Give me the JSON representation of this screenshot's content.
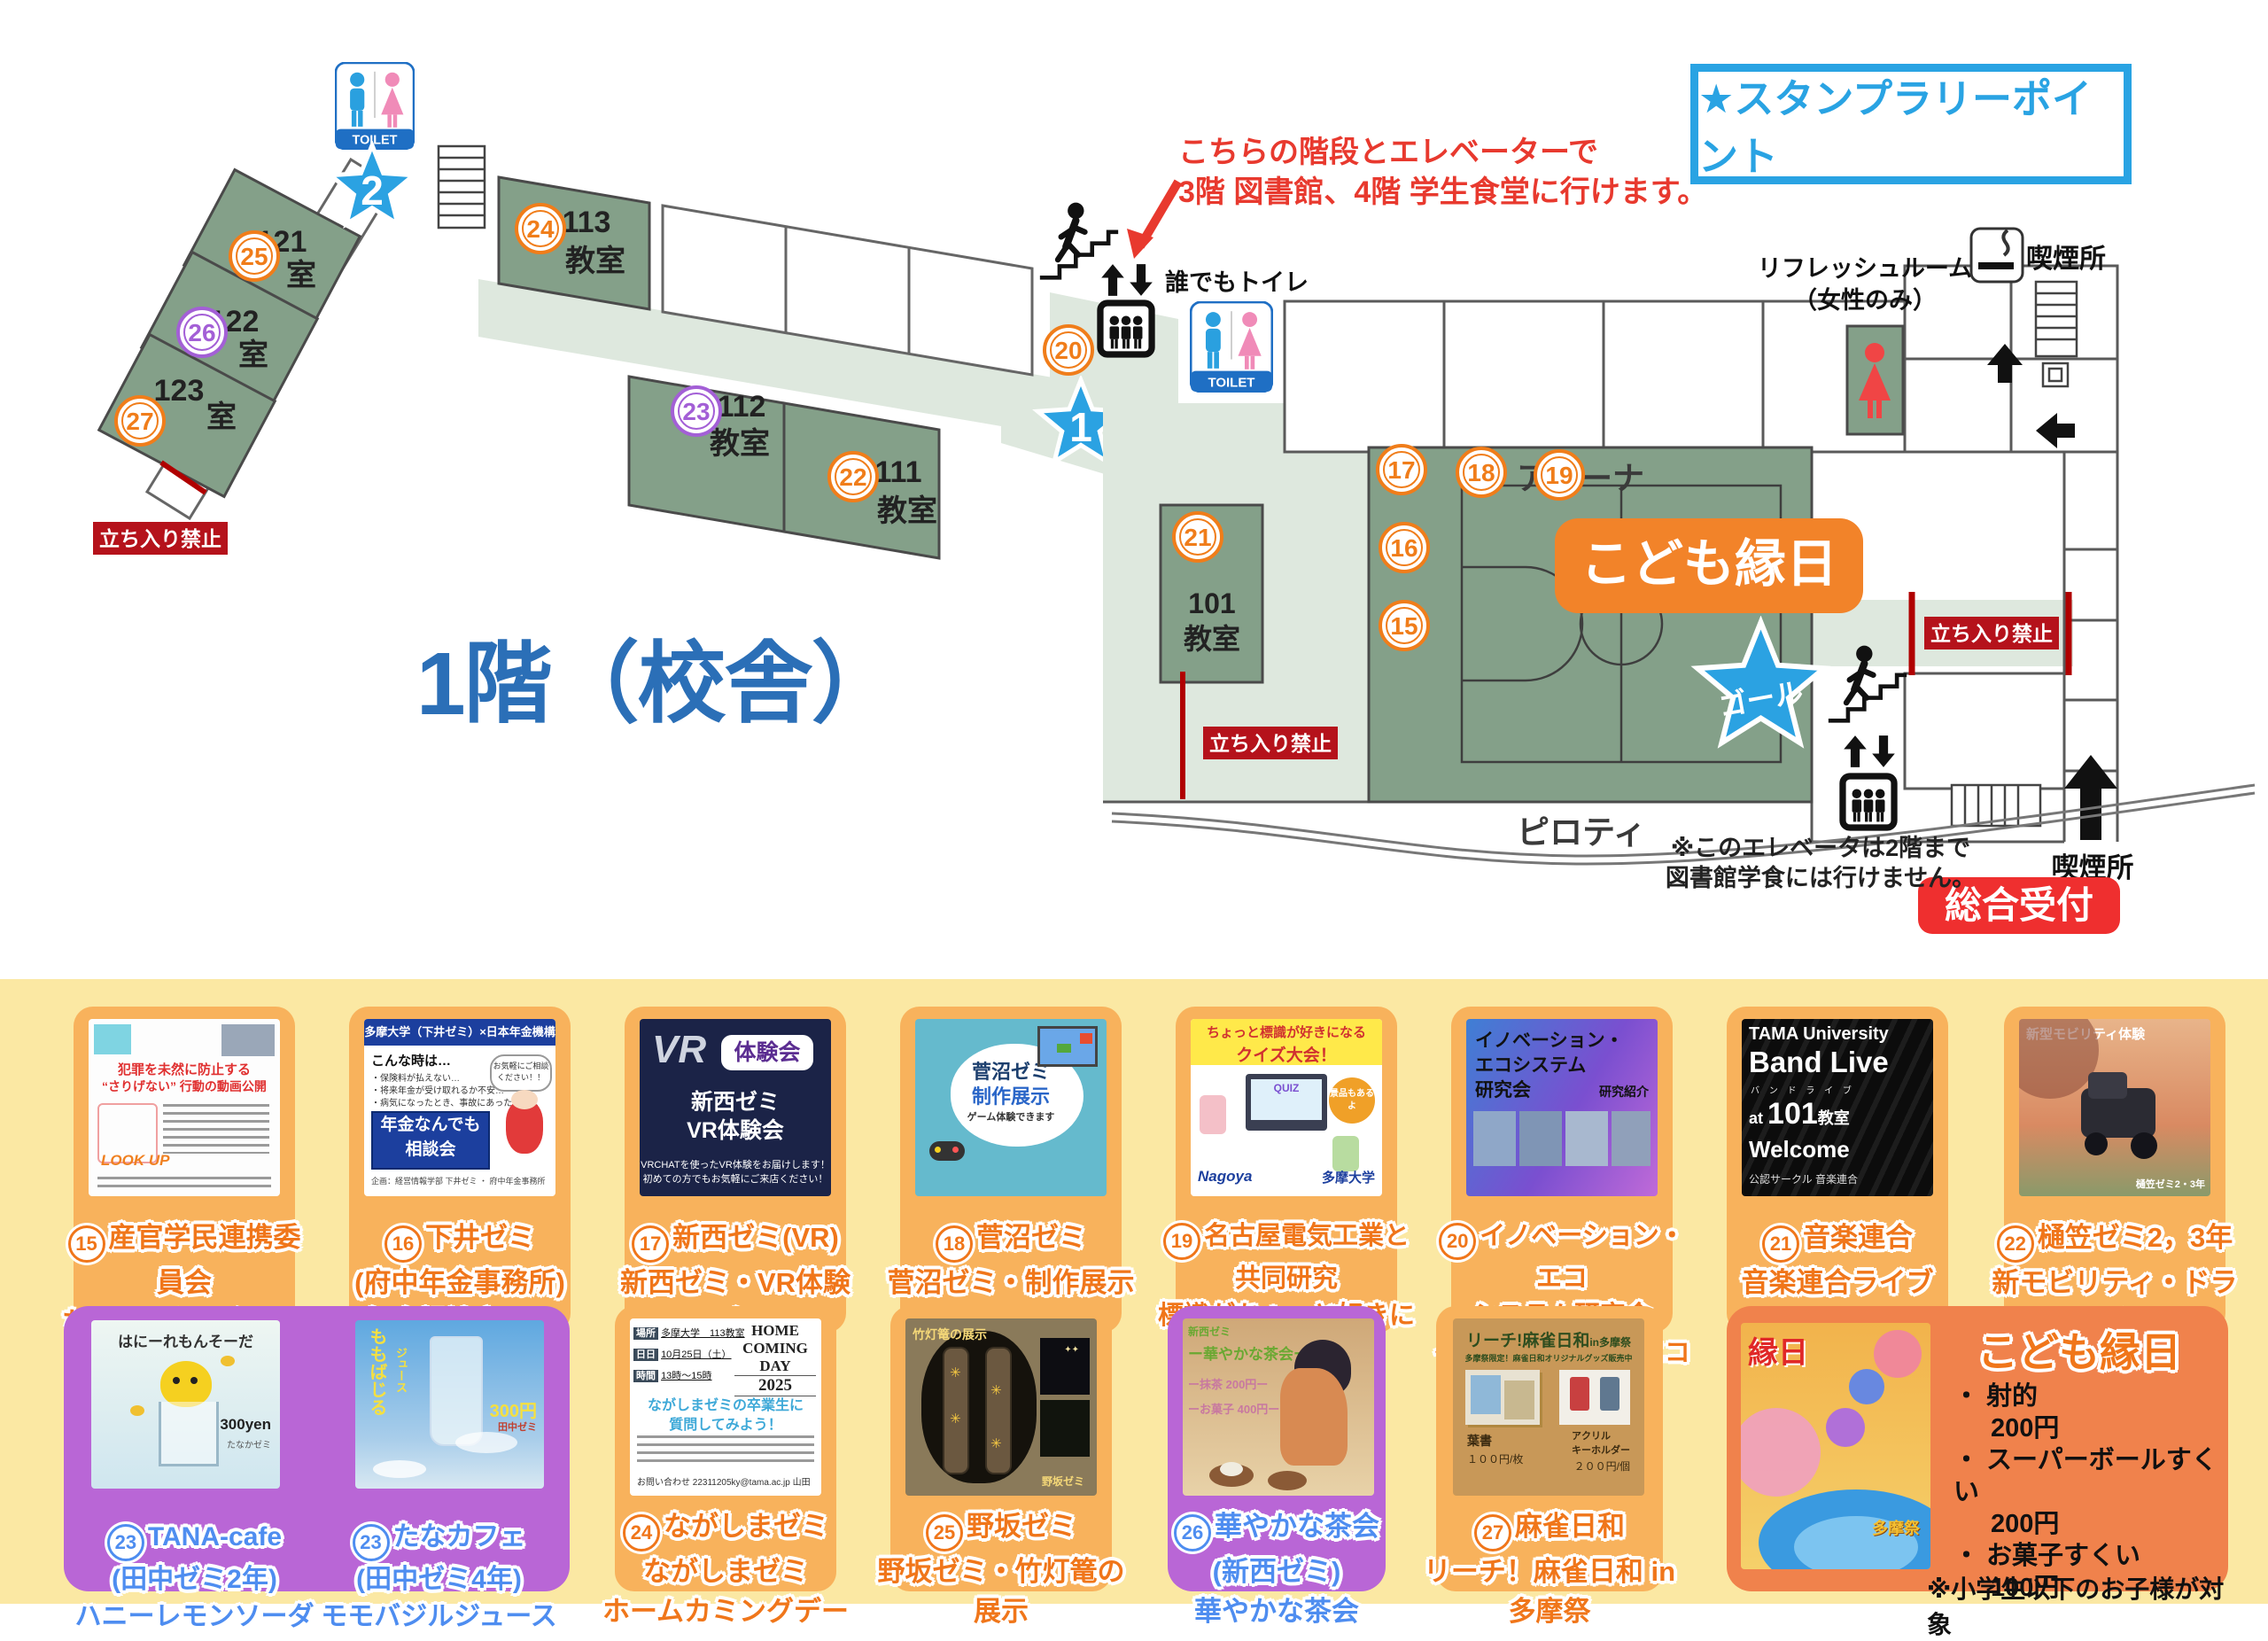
{
  "map": {
    "title": "1階（校舎）",
    "stamp": "★スタンプラリーポイント",
    "note1": "こちらの階段とエレベーターで",
    "note2": "3階 図書館、4階 学生食堂に行けます。",
    "toilet": "TOILET",
    "anyone_toilet": "誰でもトイレ",
    "refresh1": "リフレッシュルーム",
    "refresh2": "（女性のみ）",
    "smoking": "喫煙所",
    "no_entry": "立ち入り禁止",
    "pilotis": "ピロティ",
    "arena": "アリーナ",
    "goal": "ゴール",
    "reception": "総合受付",
    "elev_note1": "※このエレベータは2階まで",
    "elev_note2": "図書館学食には行けません。",
    "star1": "1",
    "star2": "2",
    "kodomo_banner": "こども縁日",
    "rooms": {
      "r113a": "113",
      "r113b": "教室",
      "r112a": "112",
      "r112b": "教室",
      "r111a": "111",
      "r111b": "教室",
      "r101a": "101",
      "r101b": "教室",
      "r121a": "121",
      "r121b": "室",
      "r122a": "122",
      "r122b": "室",
      "r123a": "123",
      "r123b": "室"
    },
    "circles": {
      "c15": "15",
      "c16": "16",
      "c17": "17",
      "c18": "18",
      "c19": "19",
      "c20": "20",
      "c21": "21",
      "c22": "22",
      "c23": "23",
      "c24": "24",
      "c25": "25",
      "c26": "26",
      "c27": "27"
    }
  },
  "colors": {
    "accent_blue": "#29A3E3",
    "star_blue": "#2BA2E2",
    "orange": "#F07D1A",
    "purple": "#A35FD6",
    "red": "#E8392E",
    "badge_red": "#B5121B",
    "banner_orange": "#F28329"
  },
  "cards": [
    {
      "num": "15",
      "lines": [
        "産官学民連携委員会",
        "ちょこっとアクション",
        "（動画配信）"
      ],
      "poster": {
        "h1": "犯罪を未然に防止する",
        "h2": "“さりげない” 行動の動画公開",
        "lookup": "LOOK UP"
      }
    },
    {
      "num": "16",
      "lines": [
        "下井ゼミ",
        "(府中年金事務所)",
        "年金相談窓口！"
      ],
      "poster": {
        "head": "多摩大学（下井ゼミ）×日本年金機構",
        "q": "こんな時は…",
        "b1": "・保険料が払えない…",
        "b2": "・将来年金が受け取れるか不安…",
        "b3": "・病気になったとき、事故にあったとき…",
        "box1": "年金なんでも",
        "box2": "相談会",
        "bubble": "お気軽にご相談ください！！",
        "foot": "企画：経営情報学部 下井ゼミ ・ 府中年金事務所"
      }
    },
    {
      "num": "17",
      "lines": [
        "新西ゼミ(VR)",
        "新西ゼミ・VR体験会"
      ],
      "poster": {
        "vr": "VR",
        "pill": "体験会",
        "t1": "新西ゼミ",
        "t2": "VR体験会",
        "s1": "VRCHATを使ったVR体験をお届けします！",
        "s2": "初めての方でもお気軽にご来店ください！"
      }
    },
    {
      "num": "18",
      "lines": [
        "菅沼ゼミ",
        "菅沼ゼミ・制作展示"
      ],
      "poster": {
        "t1": "菅沼ゼミ",
        "t2": "制作展示",
        "s": "ゲーム体験できます"
      }
    },
    {
      "num": "19",
      "lines": [
        "名古屋電気工業と",
        "共同研究",
        "標識がちょっと好きになる",
        "ゲーム"
      ],
      "poster": {
        "h1": "ちょっと標識が好きになる",
        "h2": "クイズ大会！",
        "quiz": "QUIZ",
        "bub": "景品もあるよ",
        "logo1": "Nagoya",
        "logo2": "多摩大学"
      }
    },
    {
      "num": "20",
      "lines": [
        "イノベーション・エコ",
        "システム研究会",
        "イノベーション・エコシ",
        "ステム研究会"
      ],
      "poster": {
        "t1": "イノベーション・",
        "t2": "エコシステム",
        "t3": "研究会",
        "s": "研究紹介"
      }
    },
    {
      "num": "21",
      "lines": [
        "音楽連合",
        "音楽連合ライブ"
      ],
      "poster": {
        "t1": "TAMA University",
        "t2": "Band Live",
        "t3": "バ ン ド ラ イ ブ",
        "t4": "at",
        "t5": "101",
        "t6": "教室",
        "t7": "Welcome",
        "t8": "公認サークル 音楽連合"
      }
    },
    {
      "num": "22",
      "lines": [
        "樋笠ゼミ2，3年",
        "新モビリティ・ドライ",
        "ビング教室"
      ],
      "poster": {
        "t1": "新型モビリティ体験",
        "t2": "樋笠ゼミ2・3年"
      }
    }
  ],
  "cards2": [
    {
      "num": "23",
      "lines": [
        "TANA-cafe",
        "(田中ゼミ2年)",
        "ハニーレモンソーダ"
      ],
      "poster": {
        "t1": "はにーれもんそーだ",
        "t2": "300yen",
        "t3": "たなかゼミ"
      }
    },
    {
      "num": "23",
      "lines": [
        "たなカフェ",
        "(田中ゼミ4年)",
        "モモバジルジュース"
      ],
      "poster": {
        "t1": "ももばじる",
        "t2": "ジュース",
        "t3": "300円",
        "t4": "田中ゼミ"
      }
    },
    {
      "num": "24",
      "lines": [
        "ながしまゼミ",
        "ながしまゼミ",
        "ホームカミングデー"
      ],
      "poster": {
        "h1": "HOME",
        "h2": "COMING",
        "h3": "DAY",
        "h4": "2025",
        "f1": "場所",
        "f1v": "多摩大学　113教室",
        "f2": "日日",
        "f2v": "10月25日（土）",
        "f3": "時間",
        "f3v": "13時～15時",
        "m1": "ながしまゼミの卒業生に",
        "m2": "質問してみよう！",
        "foot": "お問い合わせ 22311205ky@tama.ac.jp 山田"
      }
    },
    {
      "num": "25",
      "lines": [
        "野坂ゼミ",
        "野坂ゼミ・竹灯篭の展示"
      ],
      "poster": {
        "t1": "竹灯篭の展示",
        "t2": "野坂ゼミ"
      }
    },
    {
      "num": "26",
      "lines": [
        "華やかな茶会",
        "(新西ゼミ)",
        "華やかな茶会"
      ],
      "poster": {
        "t1": "新西ゼミ",
        "t2": "ー華やかな茶会ー",
        "t3": "ー抹茶 200円ー",
        "t4": "ーお菓子 400円ー"
      }
    },
    {
      "num": "27",
      "lines": [
        "麻雀日和",
        "リーチ！麻雀日和 in",
        "多摩祭"
      ],
      "poster": {
        "t1": "リーチ!麻雀日和",
        "t2": "in多摩祭",
        "s": "多摩祭限定！麻雀日和オリジナルグッズ販売中",
        "p1": "葉書",
        "p1v": "１００円/枚",
        "p2a": "アクリル",
        "p2b": "キーホルダー",
        "p2v": "２００円/個"
      }
    }
  ],
  "kodomo": {
    "title": "こども縁日",
    "i1": "・ 射的",
    "i1v": "200円",
    "i2": "・ スーパーボールすくい",
    "i2v": "200円",
    "i3": "・ お菓子すくい",
    "i3v": "100円",
    "note": "※小学生以下のお子様が対象",
    "poster": {
      "t1": "縁日",
      "t2": "多摩祭"
    }
  }
}
